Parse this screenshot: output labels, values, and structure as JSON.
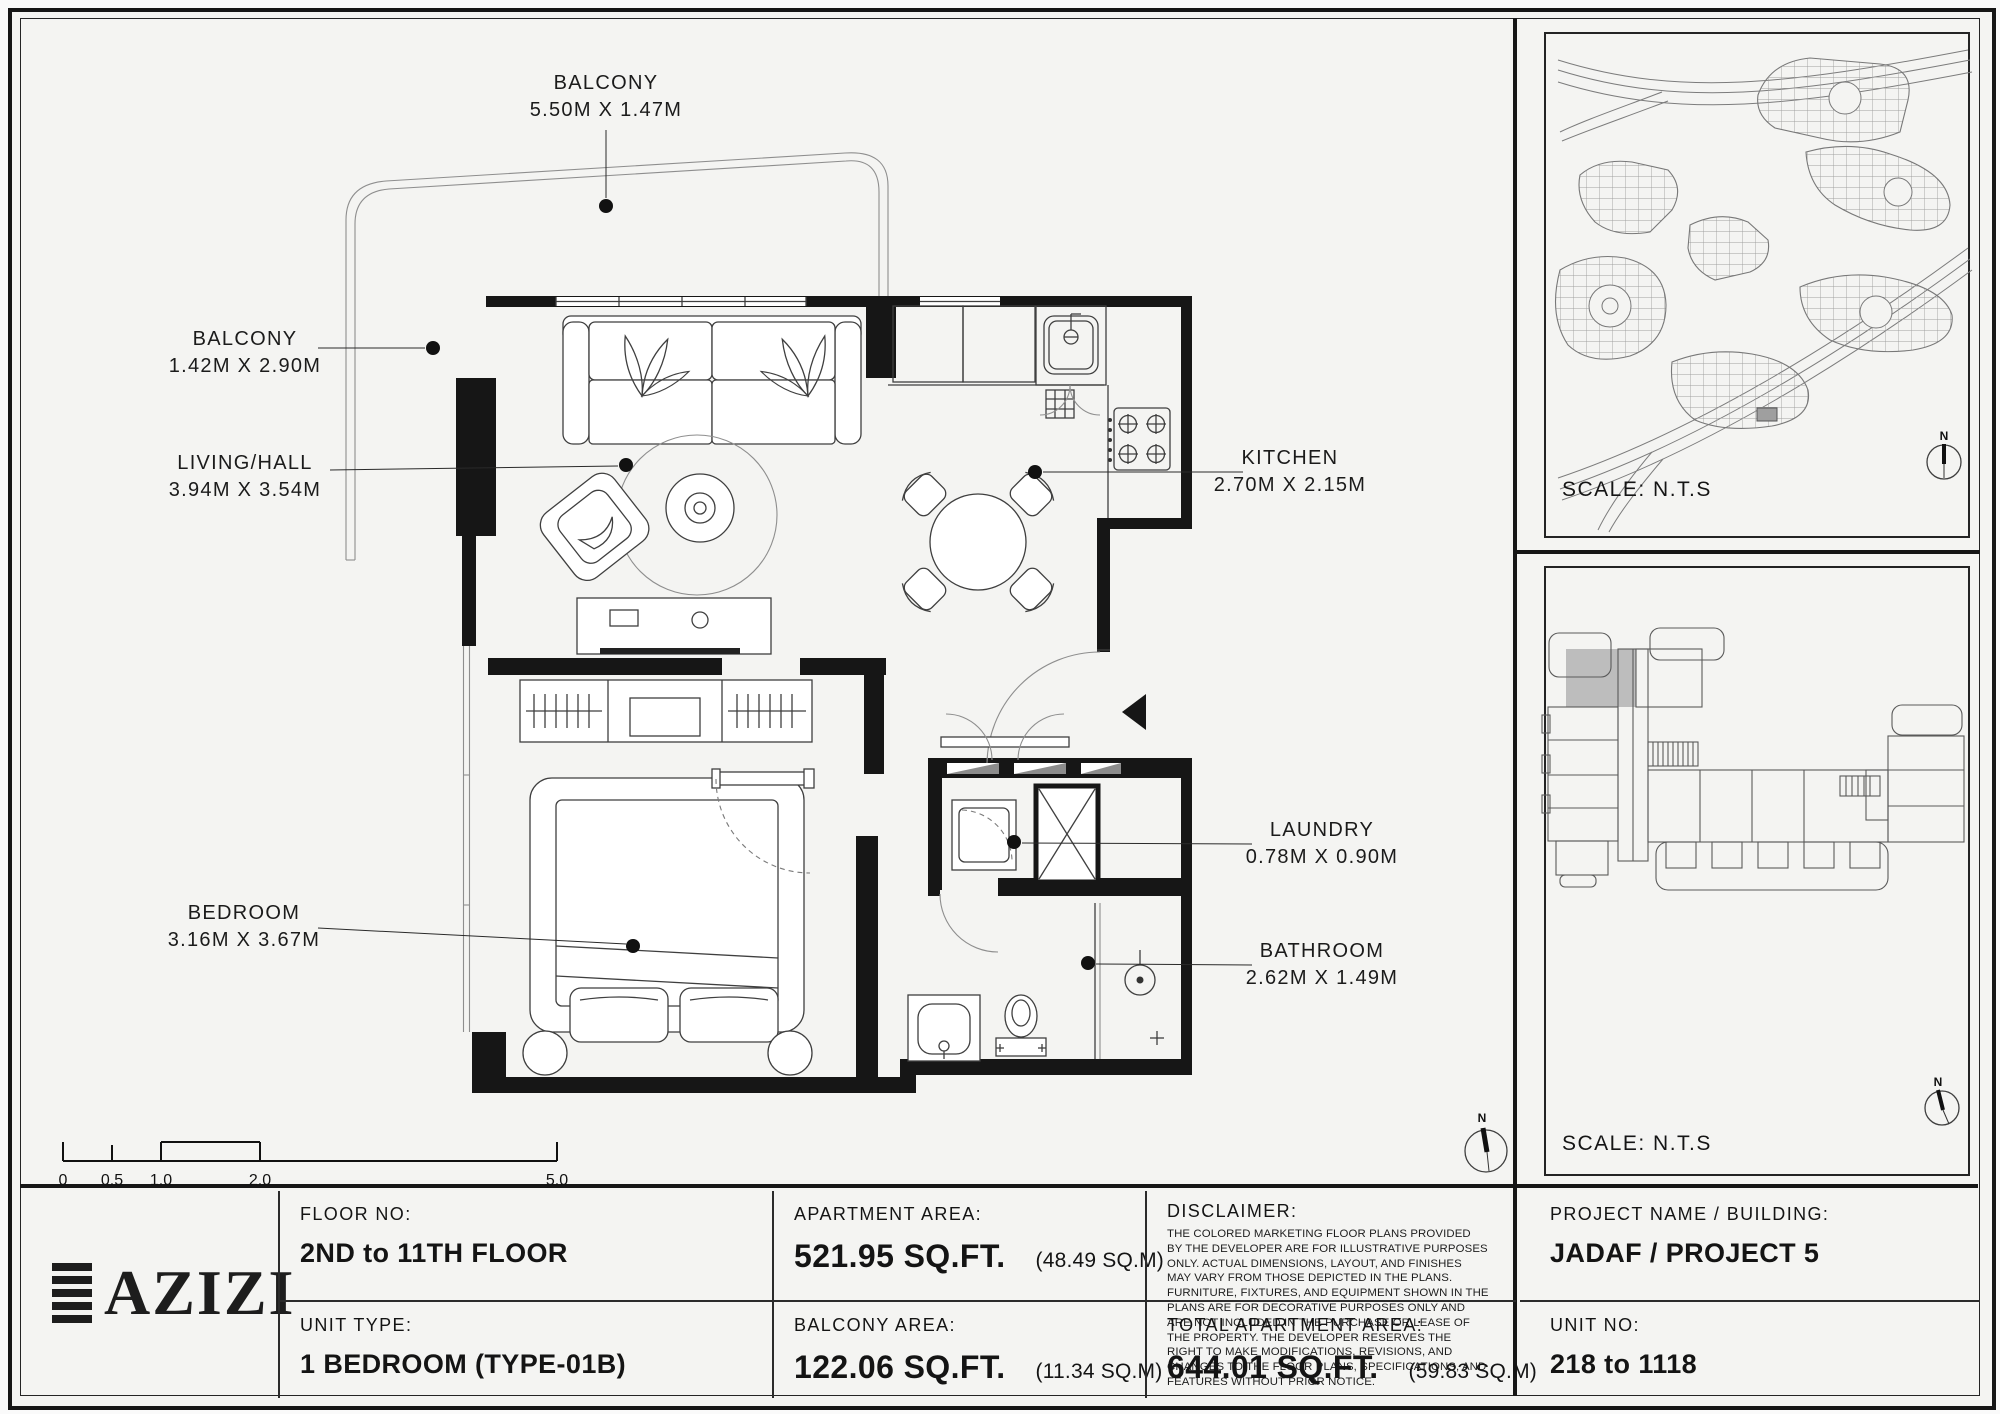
{
  "plan": {
    "labels": {
      "balcony_top": {
        "name": "BALCONY",
        "dims": "5.50M X 1.47M"
      },
      "balcony_left": {
        "name": "BALCONY",
        "dims": "1.42M X 2.90M"
      },
      "living": {
        "name": "LIVING/HALL",
        "dims": "3.94M X 3.54M"
      },
      "kitchen": {
        "name": "KITCHEN",
        "dims": "2.70M X 2.15M"
      },
      "laundry": {
        "name": "LAUNDRY",
        "dims": "0.78M X 0.90M"
      },
      "bathroom": {
        "name": "BATHROOM",
        "dims": "2.62M X 1.49M"
      },
      "bedroom": {
        "name": "BEDROOM",
        "dims": "3.16M X 3.67M"
      }
    }
  },
  "scale_bar": {
    "t0": "0",
    "t1": "0.5",
    "t2": "1.0",
    "t3": "2.0",
    "t4": "5.0"
  },
  "compass": {
    "north": "N"
  },
  "site_panel": {
    "scale": "SCALE: N.T.S"
  },
  "key_panel": {
    "scale": "SCALE: N.T.S"
  },
  "footer": {
    "brand": "AZIZI",
    "floor_label": "FLOOR NO:",
    "floor_value": "2ND to 11TH FLOOR",
    "unit_type_label": "UNIT TYPE:",
    "unit_type_value": "1 BEDROOM (TYPE-01B)",
    "apartment_area_label": "APARTMENT AREA:",
    "apartment_area_value": "521.95 SQ.FT.",
    "apartment_area_m": "(48.49 SQ.M)",
    "balcony_area_label": "BALCONY AREA:",
    "balcony_area_value": "122.06 SQ.FT.",
    "balcony_area_m": "(11.34 SQ.M)",
    "disclaimer_label": "DISCLAIMER:",
    "disclaimer_text": "THE COLORED MARKETING FLOOR PLANS PROVIDED BY THE DEVELOPER ARE FOR ILLUSTRATIVE PURPOSES ONLY. ACTUAL DIMENSIONS, LAYOUT, AND FINISHES MAY VARY FROM THOSE DEPICTED IN THE PLANS. FURNITURE, FIXTURES, AND EQUIPMENT SHOWN IN THE PLANS ARE FOR DECORATIVE PURPOSES ONLY AND ARE NOT INCLUDED IN THE PURCHASE OR LEASE OF THE PROPERTY. THE DEVELOPER RESERVES THE RIGHT TO MAKE MODIFICATIONS, REVISIONS, AND CHANGES TO THE FLOOR PLANS, SPECIFICATIONS, AND FEATURES WITHOUT PRIOR NOTICE.",
    "total_area_label": "TOTAL APARTMENT AREA:",
    "total_area_value": "644.01 SQ.FT.",
    "total_area_m": "(59.83 SQ.M)",
    "project_label": "PROJECT NAME / BUILDING:",
    "project_value": "JADAF / PROJECT 5",
    "unit_no_label": "UNIT NO:",
    "unit_no_value": "218 to 1118"
  }
}
